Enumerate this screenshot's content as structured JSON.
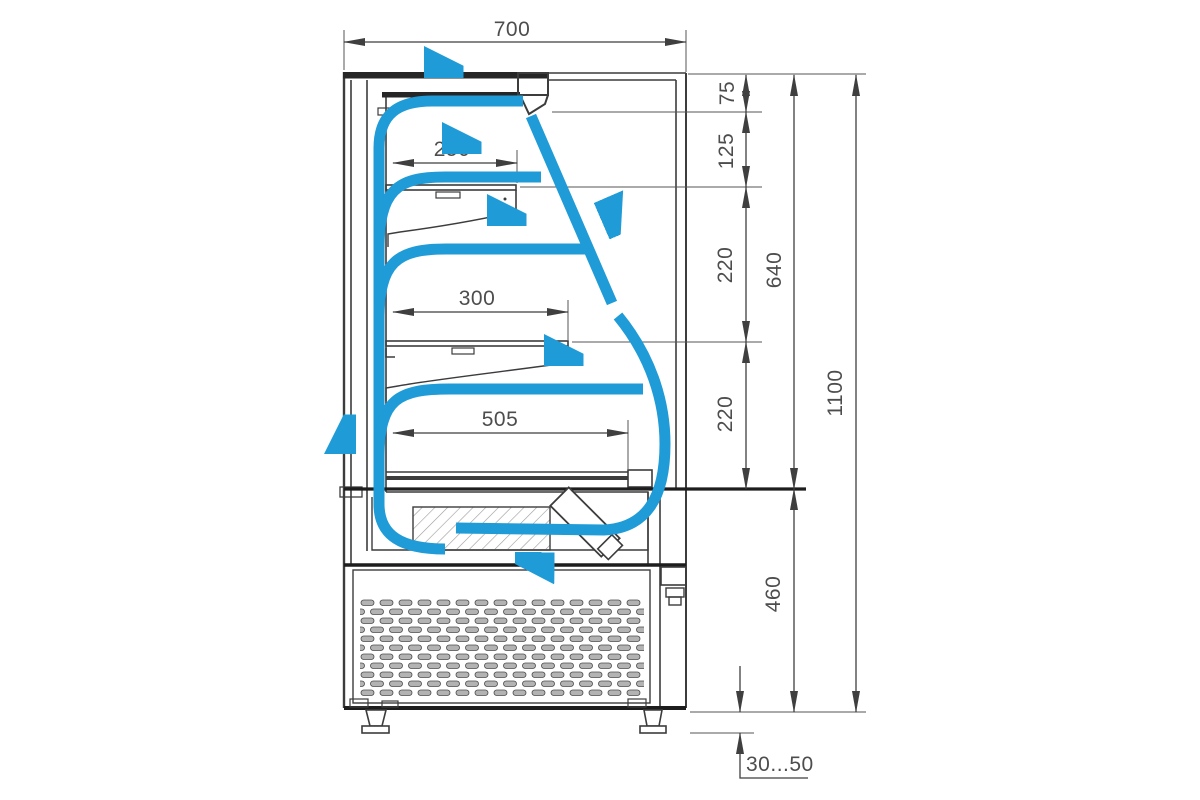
{
  "drawing": {
    "title": "Refrigerated display case — side cross-section with air flow",
    "colors": {
      "airflow_blue": "#1f9bd7",
      "line_dark": "#333333",
      "dim_text_gray": "#4d4d4d"
    },
    "dims": {
      "overall_depth": "700",
      "air_gap_top": "75",
      "gap_canopy_to_shelf1": "125",
      "gap_shelf1_to_shelf2": "220",
      "gap_shelf2_to_deck": "220",
      "display_opening_height": "640",
      "overall_height": "1100",
      "base_height": "460",
      "shelf1_depth": "250",
      "shelf2_depth": "300",
      "deck_depth": "505",
      "feet_adjust_range": "30...50"
    }
  }
}
